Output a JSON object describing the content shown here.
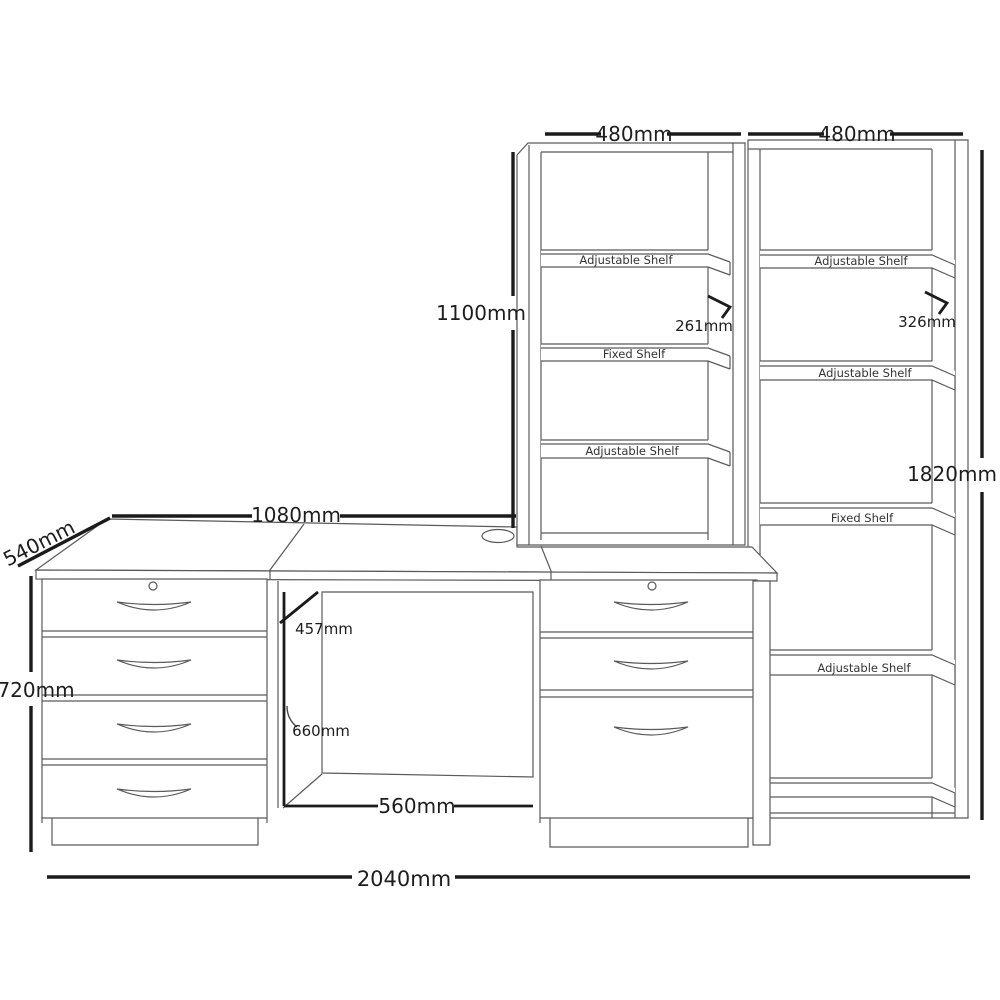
{
  "diagram_title": "Desk with pedestals, hutch and bookcase dimension diagram",
  "dims": {
    "hutch_width": "480mm",
    "bookcase_width": "480mm",
    "hutch_height": "1100mm",
    "hutch_shelf_depth": "261mm",
    "bookcase_shelf_depth": "326mm",
    "bookcase_height": "1820mm",
    "desk_width": "1080mm",
    "desk_depth": "540mm",
    "desk_height": "720mm",
    "kneehole_depth": "457mm",
    "kneehole_height": "660mm",
    "kneehole_width": "560mm",
    "total_width": "2040mm"
  },
  "hutch_shelves": [
    "Adjustable Shelf",
    "Fixed Shelf",
    "Adjustable Shelf"
  ],
  "bookcase_shelves": [
    "Adjustable Shelf",
    "Adjustable Shelf",
    "Fixed Shelf",
    "Adjustable Shelf"
  ],
  "colors": {
    "line": "#5a5a5a",
    "dimension_line": "#1b1b1b",
    "background": "#ffffff"
  }
}
